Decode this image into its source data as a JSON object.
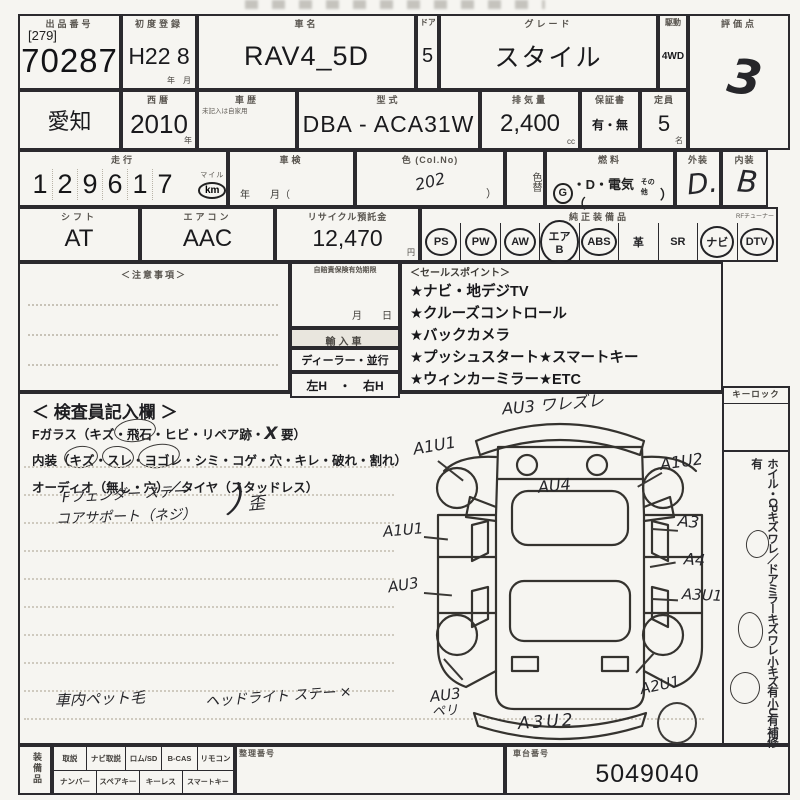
{
  "row1": {
    "lot_label": "出品番号",
    "lot_bracket": "[279]",
    "lot_number": "70287",
    "firstreg_label": "初度登録",
    "firstreg_value": "H22 8",
    "firstreg_units": "年　月",
    "name_label": "車名",
    "name_value": "RAV4_5D",
    "door_label": "ドア",
    "door_value": "5",
    "grade_label": "グレード",
    "grade_value": "スタイル",
    "drive_label": "駆動",
    "drive_value": "4WD",
    "score_label": "評価点",
    "score_value": "3"
  },
  "row2": {
    "prefecture": "愛知",
    "year_label": "西暦",
    "year_value": "2010",
    "year_unit": "年",
    "history_label": "車歴",
    "history_note": "未記入は自家用",
    "model_label": "型式",
    "model_value": "DBA - ACA31W",
    "disp_label": "排気量",
    "disp_value": "2,400",
    "disp_unit": "cc",
    "warranty_label": "保証書",
    "warranty_value": "有・無",
    "capacity_label": "定員",
    "capacity_value": "5",
    "capacity_unit": "名"
  },
  "row3": {
    "mileage_label": "走行",
    "mileage_digits": [
      "1",
      "2",
      "9",
      "6",
      "1",
      "7"
    ],
    "mile_unit": "マイル",
    "km_unit": "km",
    "shaken_label": "車検",
    "shaken_units": "年　　月（",
    "color_label": "色 (Col.No)",
    "color_value": "202",
    "color_close": "）",
    "colorchg_label": "色替",
    "fuel_label": "燃料",
    "fuel_g": "G",
    "fuel_rest": "・D・電気（",
    "fuel_other": "その他",
    "fuel_close": "）",
    "ext_label": "外装",
    "ext_value": "D.",
    "int_label": "内装",
    "int_value": "B"
  },
  "row4": {
    "shift_label": "シフト",
    "shift_value": "AT",
    "ac_label": "エアコン",
    "ac_value": "AAC",
    "recycle_label": "リサイクル預託金",
    "recycle_value": "12,470",
    "recycle_unit": "円",
    "equip_label": "純正装備品",
    "equip_note": "RFチューナー",
    "equipment": [
      {
        "label": "PS",
        "circled": true
      },
      {
        "label": "PW",
        "circled": true
      },
      {
        "label": "AW",
        "circled": true
      },
      {
        "label": "エアB",
        "circled": true
      },
      {
        "label": "ABS",
        "circled": true
      },
      {
        "label": "革",
        "circled": false
      },
      {
        "label": "SR",
        "circled": false
      },
      {
        "label": "ナビ",
        "circled": true
      },
      {
        "label": "DTV",
        "circled": true
      }
    ]
  },
  "middle": {
    "notes_label": "＜注意事項＞",
    "insurance_label": "自賠責保険有効期限",
    "insurance_units": "月　　日",
    "import_label": "輸入車",
    "import_type": "ディーラー・並行",
    "handle": "左H　・　右H",
    "sales_label": "＜セールスポイント＞",
    "sales_points": [
      "★ナビ・地デジTV",
      "★クルーズコントロール",
      "★バックカメラ",
      "★プッシュスタート★スマートキー",
      "★ウィンカーミラー★ETC"
    ]
  },
  "inspector": {
    "title": "＜ 検査員記入欄 ＞",
    "glass_line": "Fガラス（キズ・飛石・ヒビ・リペア跡・",
    "glass_x": "X",
    "glass_req": "要）",
    "interior_line": "内装（キズ・スレ・ヨゴレ・シミ・コゲ・穴・キレ・破れ・割れ）",
    "audio_line": "オーディオ（無し・穴）／タイヤ（スタッドレス）",
    "note_fender": "Fフェンダー ステー",
    "note_core": "コアサポート（ネジ）",
    "note_brace": "）",
    "note_hizumi": "歪",
    "note_pet": "車内ペット毛",
    "note_headlight": "ヘッドライト ステー ×"
  },
  "diagram": {
    "front_bumper": "AU3 ワレズレ",
    "lf_fender": "A1U1",
    "rf_fender": "A1U2",
    "hood": "AU4",
    "lf_door": "A1U1",
    "rf_door": "A3",
    "lr_door": "AU3",
    "rr_door": "A4",
    "rr_fender": "A3U1",
    "lr_corner": "AU3",
    "lr_corner2": "ペリ",
    "rr_corner": "A2U1",
    "rear_bumper": "A3U2"
  },
  "sidebar": {
    "keylock_label": "キーロック",
    "line1": "ホイル・CPキズ ワレ／ドアミラーキズ ワレ",
    "line2": "小キズ有 小U有 補修有"
  },
  "bottom": {
    "section_label": "装備品",
    "row1": [
      "取説",
      "ナビ取説",
      "ロム/SD",
      "B-CAS",
      "リモコン"
    ],
    "row2": [
      "ナンバー",
      "スペアキー",
      "キーレス",
      "スマートキー"
    ],
    "seiri_label": "整理番号",
    "chassis_label": "車台番号",
    "chassis_value": "5049040"
  }
}
